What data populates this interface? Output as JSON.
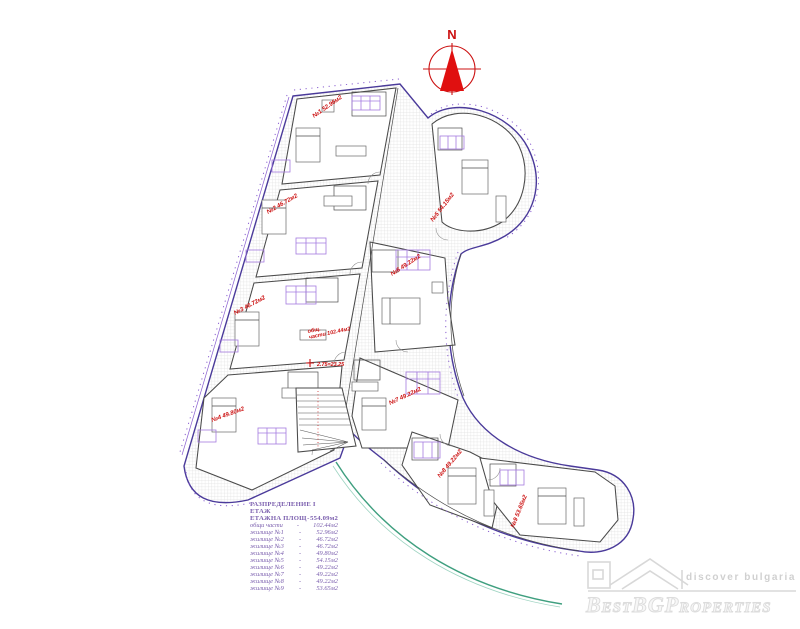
{
  "colors": {
    "outline_purple": "#4a3a9a",
    "wall_gray": "#4a4a4a",
    "furniture_purple": "#a57be0",
    "dim_purple": "#8a5fd0",
    "label_red": "#cc1111",
    "legend_purple": "#7b5fae",
    "terrace_green": "#3f9f7f"
  },
  "compass": {
    "label": "N"
  },
  "plan": {
    "unit_labels": [
      {
        "text": "№1 52.96м2"
      },
      {
        "text": "№2 46.72м2"
      },
      {
        "text": "№3 46.72м2"
      },
      {
        "text": "№4 49.80м2"
      },
      {
        "text": "№5 54.15м2"
      },
      {
        "text": "№6 49.22м2"
      },
      {
        "text": "№7 49.22м2"
      },
      {
        "text": "№8 49.22м2"
      },
      {
        "text": "№9 53.65м2"
      }
    ],
    "common_area": {
      "line1": "общ.",
      "line2": "части 102.44м2"
    },
    "level_mark": "2.75=23.25"
  },
  "legend": {
    "title": "РАЗПРЕДЕЛЕНИЕ  I ЕТАЖ",
    "rows": [
      {
        "label": "ЕТАЖНА ПЛОЩ",
        "value": "554.09м2",
        "big": true
      },
      {
        "label": "общи части",
        "value": "102.44м2"
      },
      {
        "label": "жилище №1",
        "value": "52.96м2"
      },
      {
        "label": "жилище №2",
        "value": "46.72м2"
      },
      {
        "label": "жилище №3",
        "value": "46.72м2"
      },
      {
        "label": "жилище №4",
        "value": "49.80м2"
      },
      {
        "label": "жилище №5",
        "value": "54.15м2"
      },
      {
        "label": "жилище №6",
        "value": "49.22м2"
      },
      {
        "label": "жилище №7",
        "value": "49.22м2"
      },
      {
        "label": "жилище №8",
        "value": "49.22м2"
      },
      {
        "label": "жилище №9",
        "value": "53.65м2"
      }
    ]
  },
  "watermark": {
    "tagline": "discover bulgaria",
    "brand": "BestBGProperties"
  }
}
